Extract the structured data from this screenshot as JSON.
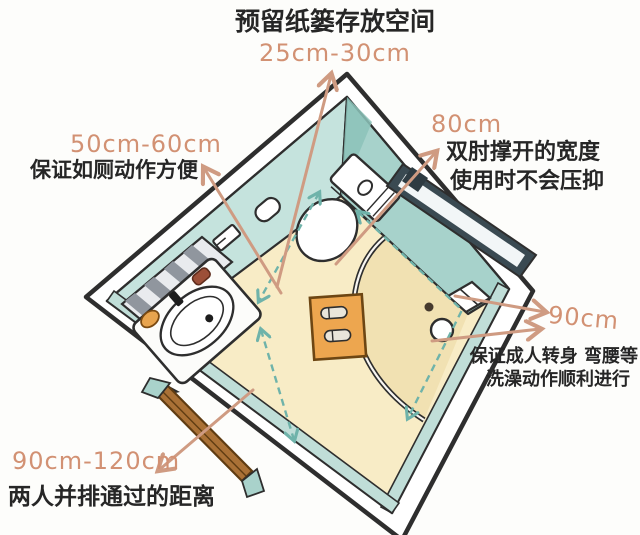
{
  "annotations": {
    "trash_space": {
      "label": "预留纸篓存放空间",
      "dim": "25cm-30cm"
    },
    "toilet_side": {
      "dim": "50cm-60cm",
      "label": "保证如厕动作方便"
    },
    "elbow_width": {
      "dim": "80cm",
      "label_line1": "双肘撑开的宽度",
      "label_line2": "使用时不会压抑"
    },
    "shower_radius": {
      "dim": "90cm",
      "label_line1": "保证成人转身 弯腰等",
      "label_line2": "洗澡动作顺利进行"
    },
    "door_passage": {
      "dim": "90cm-120cm",
      "label": "两人并排通过的距离"
    }
  },
  "colors": {
    "dim_text": "#d29173",
    "label_text": "#262626",
    "arrow": "#cf9b82",
    "dashed_line": "#6fb3aa",
    "wall_teal": "#a7d2cb",
    "wall_teal_light": "#c5e3dd",
    "floor": "#f8ecc6",
    "shower_floor": "#f1e1b2",
    "outline": "#2e2e2e",
    "mat_orange": "#eda64f",
    "door_brown": "#aa7136"
  },
  "fixtures": [
    "sink-counter",
    "washbasin",
    "faucet",
    "window-blinds",
    "toilet",
    "glass-panel",
    "shower-curtain-rail",
    "shower-fixture",
    "bath-mat",
    "slippers",
    "door",
    "toilet-paper-holder",
    "wall-shelf"
  ]
}
